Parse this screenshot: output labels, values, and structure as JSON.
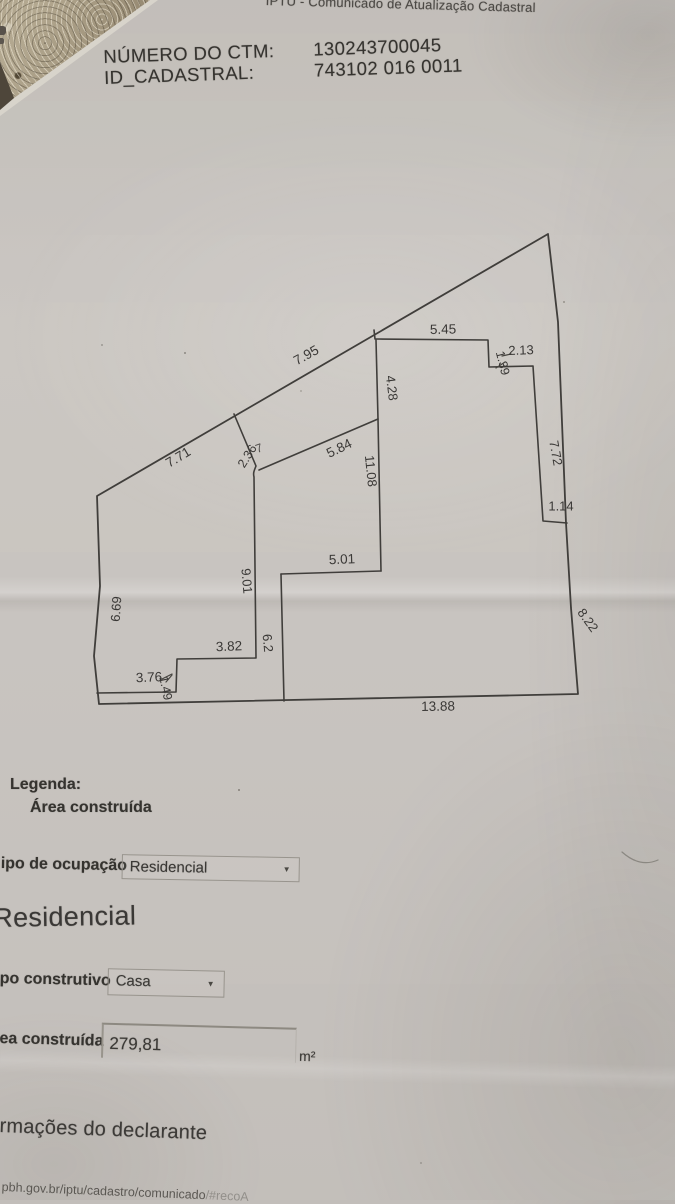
{
  "photo": {
    "title_partial": "IPTU - Comunicado de Atualização Cadastral"
  },
  "header": {
    "ctm_label": "NÚMERO DO CTM:",
    "id_label": "ID_CADASTRAL:",
    "ctm_value": "130243700045",
    "id_value": "743102 016 0011"
  },
  "plan": {
    "description": "cadastral lot sketch with constructed area outline",
    "labels": [
      {
        "t": "5.45"
      },
      {
        "t": "2.13"
      },
      {
        "t": "1.39"
      },
      {
        "t": "7.95"
      },
      {
        "t": "4.28"
      },
      {
        "t": "7.71"
      },
      {
        "t": "2.36"
      },
      {
        "t": "7"
      },
      {
        "t": "5.84"
      },
      {
        "t": "11.08"
      },
      {
        "t": "7.72"
      },
      {
        "t": "1.14"
      },
      {
        "t": "8.22"
      },
      {
        "t": "5.01"
      },
      {
        "t": "9.01"
      },
      {
        "t": "6.2"
      },
      {
        "t": "3.82"
      },
      {
        "t": "6.69"
      },
      {
        "t": "3.76"
      },
      {
        "t": "1.49"
      },
      {
        "t": "13.88"
      }
    ]
  },
  "legend": {
    "title": "Legenda:",
    "item": "Área construída"
  },
  "form": {
    "occupation_label": "ipo de ocupação",
    "occupation_value": "Residencial",
    "occupation_caret": "▼",
    "subtitle": "Residencial",
    "construction_label": "po construtivo",
    "construction_value": "Casa",
    "construction_caret": "▼",
    "area_label": "ea construída",
    "area_value": "279,81",
    "area_unit": "m²",
    "declarant_heading": "rmações do declarante"
  },
  "footer": {
    "url": "pbh.gov.br/iptu/cadastro/comunicado",
    "url_tail": "/#recoA"
  },
  "colors": {
    "paper": "#c8c4bf",
    "ink": "#3a3836",
    "fabric": "#a79c87"
  }
}
